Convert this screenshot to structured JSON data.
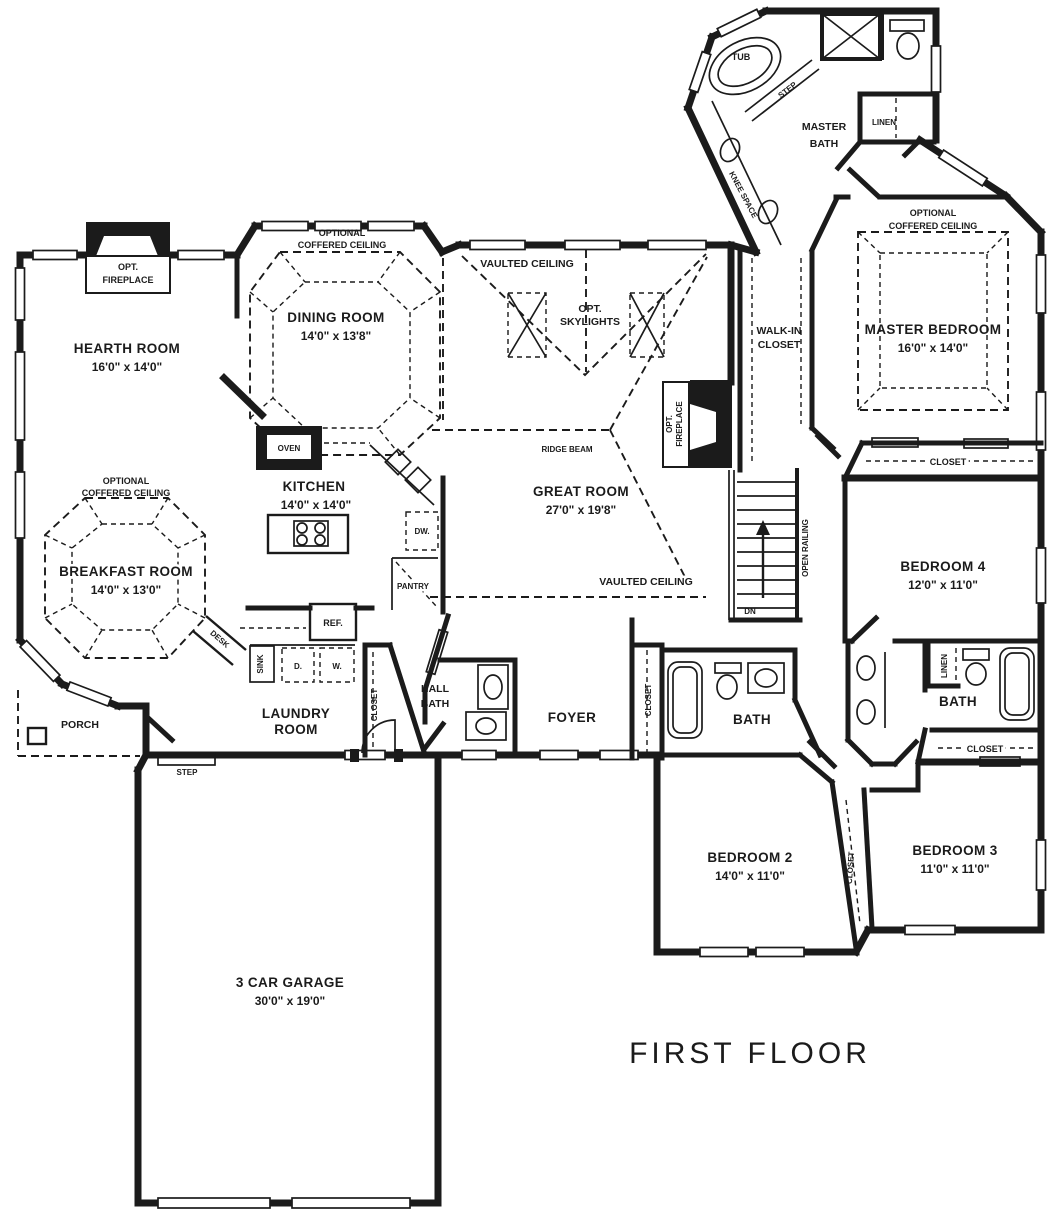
{
  "title": "FIRST FLOOR",
  "colors": {
    "ink": "#1b1b1b",
    "paper": "#ffffff"
  },
  "rooms": {
    "hearth": {
      "name": "HEARTH ROOM",
      "dims": "16'0\" x 14'0\""
    },
    "dining": {
      "name": "DINING ROOM",
      "dims": "14'0\" x 13'8\""
    },
    "great": {
      "name": "GREAT ROOM",
      "dims": "27'0\" x 19'8\""
    },
    "kitchen": {
      "name": "KITCHEN",
      "dims": "14'0\" x 14'0\""
    },
    "breakfast": {
      "name": "BREAKFAST ROOM",
      "dims": "14'0\" x 13'0\""
    },
    "master_bedroom": {
      "name": "MASTER BEDROOM",
      "dims": "16'0\" x 14'0\""
    },
    "master_bath": {
      "line1": "MASTER",
      "line2": "BATH"
    },
    "walk_in_closet": {
      "line1": "WALK-IN",
      "line2": "CLOSET"
    },
    "bedroom2": {
      "name": "BEDROOM 2",
      "dims": "14'0\" x 11'0\""
    },
    "bedroom3": {
      "name": "BEDROOM 3",
      "dims": "11'0\" x 11'0\""
    },
    "bedroom4": {
      "name": "BEDROOM 4",
      "dims": "12'0\" x 11'0\""
    },
    "laundry": {
      "line1": "LAUNDRY",
      "line2": "ROOM"
    },
    "hall_bath": {
      "line1": "HALL",
      "line2": "BATH"
    },
    "bath": {
      "name": "BATH"
    },
    "foyer": {
      "name": "FOYER"
    },
    "porch": {
      "name": "PORCH"
    },
    "garage": {
      "name": "3 CAR GARAGE",
      "dims": "30'0\" x 19'0\""
    }
  },
  "labels": {
    "optional": "OPTIONAL",
    "coffered_ceiling": "COFFERED CEILING",
    "vaulted_ceiling": "VAULTED CEILING",
    "opt": "OPT.",
    "fireplace": "FIREPLACE",
    "skylights": "SKYLIGHTS",
    "ridge_beam": "RIDGE BEAM",
    "tub": "TUB",
    "step": "STEP",
    "linen": "LINEN",
    "knee_space": "KNEE SPACE",
    "closet": "CLOSET",
    "open_railing": "OPEN RAILING",
    "dn": "DN",
    "oven": "OVEN",
    "dw": "DW.",
    "pantry": "PANTRY",
    "ref": "REF.",
    "sink": "SINK",
    "desk": "DESK",
    "dryer": "D.",
    "washer": "W."
  }
}
